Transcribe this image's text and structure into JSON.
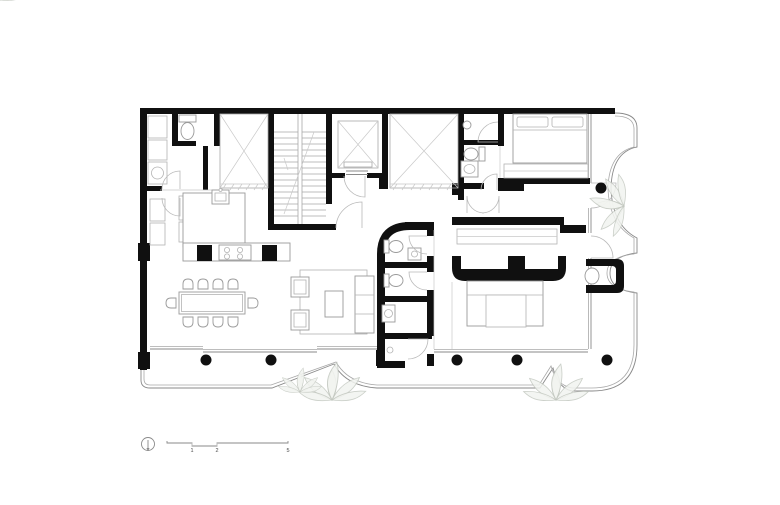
{
  "drawing": {
    "type": "architectural floor plan",
    "scale_bar": {
      "labels": [
        "1",
        "2",
        "5"
      ]
    },
    "icons": {
      "north_arrow": "north-arrow-icon",
      "column": "structural-column-dot",
      "void_shaft": "crossed-box-shaft",
      "stair": "u-stair-run",
      "plant": "leaf-cluster"
    },
    "colors": {
      "wall": "#101010",
      "line_medium": "#8a8a8a",
      "line_light": "#a8a8a8",
      "line_faint": "#c9c9c9",
      "plant": "#c3c8c0",
      "background": "#ffffff"
    }
  }
}
